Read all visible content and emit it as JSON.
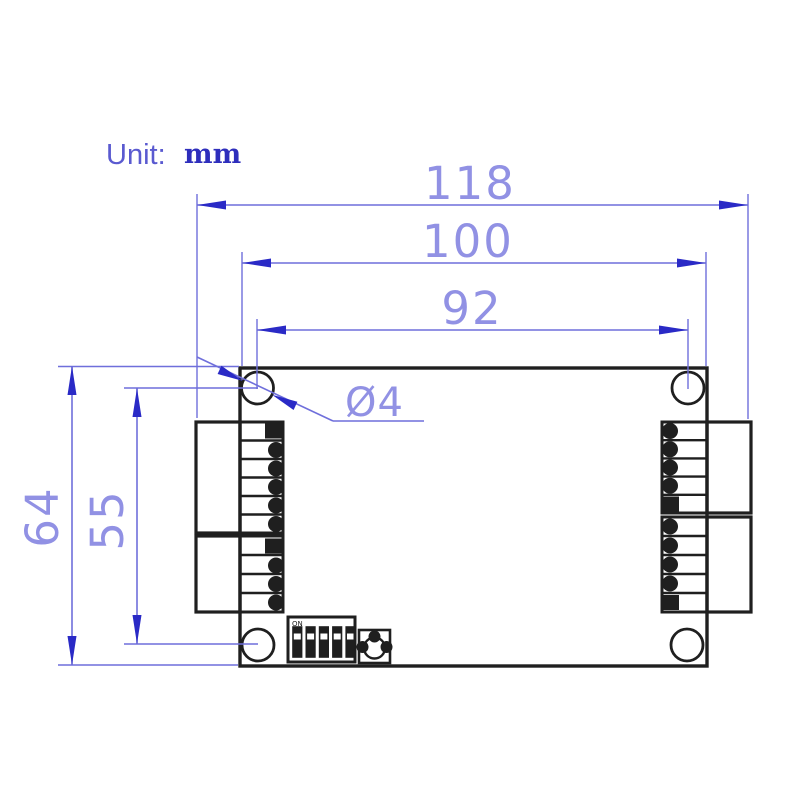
{
  "unit": {
    "label": "Unit:",
    "value": "mm"
  },
  "dimensions": {
    "overall_width": "118",
    "board_width": "100",
    "hole_pitch_x": "92",
    "overall_height": "64",
    "hole_pitch_y": "55",
    "hole_diameter": "Ø4"
  },
  "dip_switch": {
    "on_label": "ON",
    "positions": 5
  },
  "colors": {
    "dimension_line": "#6f6fdb",
    "dimension_text": "#9191e4",
    "arrow": "#2a2ac6",
    "unit_label": "#5a5ad0",
    "unit_value": "#2e2ebc",
    "outline_ink": "#1f1f1f",
    "background": "#ffffff"
  }
}
